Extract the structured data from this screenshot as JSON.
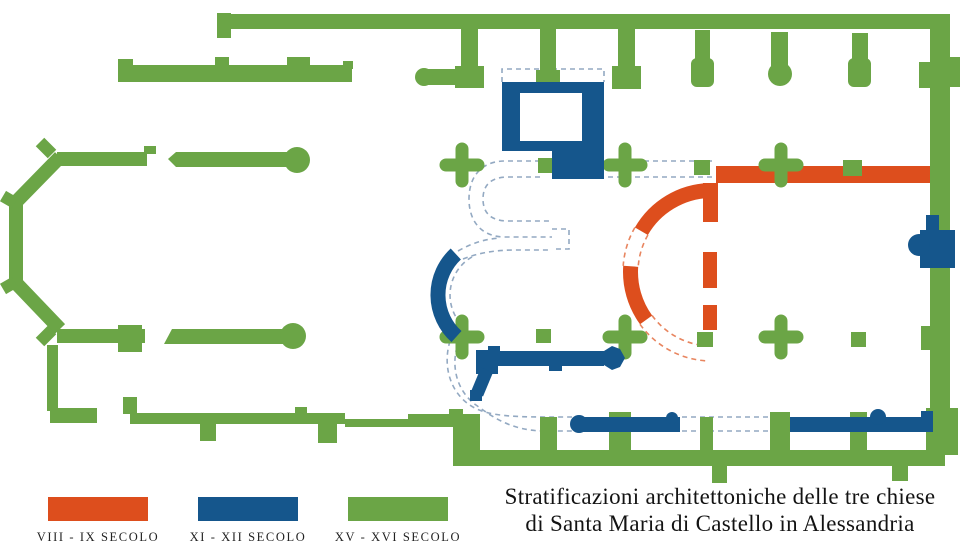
{
  "title": {
    "line1": "Stratificazioni architettoniche delle tre chiese",
    "line2": "di Santa Maria di Castello in Alessandria"
  },
  "legend": {
    "items": [
      {
        "label": "VIII - IX SECOLO",
        "color": "#DD4E1D"
      },
      {
        "label": "XI - XII SECOLO",
        "color": "#15568C"
      },
      {
        "label": "XV - XVI SECOLO",
        "color": "#6BA546"
      }
    ]
  },
  "plan": {
    "colors": {
      "phase_8_9_century": "#DD4E1D",
      "phase_11_12_century": "#15568C",
      "phase_15_16_century": "#6BA546",
      "hypothetical_outline_blue": "#93A9C2",
      "hypothetical_outline_orange": "#E8855F",
      "background": "#FFFFFF"
    }
  }
}
